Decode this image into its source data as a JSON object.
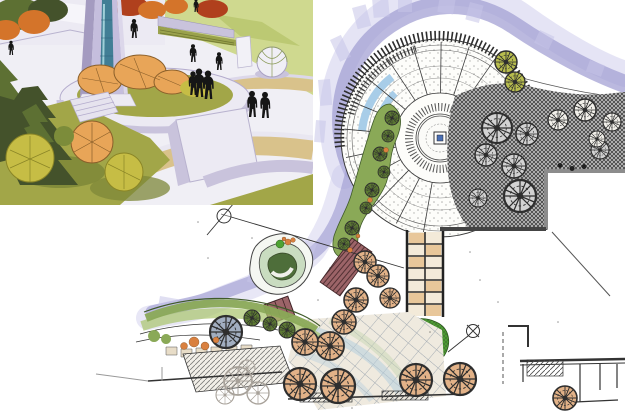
{
  "colors": {
    "paper": "#ffffff",
    "plazaLight": "#f0eff5",
    "bgGreen": "#cfd98f",
    "bgGreenDark": "#bcc973",
    "grassMid": "#a2a648",
    "grassLight": "#b7bb60",
    "grassShadow": "#7e8738",
    "wallLight": "#eceaf3",
    "wallMid": "#c9c3dc",
    "wallDark": "#a79fc2",
    "paveTan": "#d9c28b",
    "monumentBody": "#c5bedd",
    "monumentDark": "#a49bc0",
    "monumentEdge": "#dcd7ea",
    "glassTeal": "#417e95",
    "glassShine": "#9fd0d8",
    "shrubOrange": "#e8a558",
    "shrubOutline": "#8a5f2a",
    "shrubYellow": "#c6bd45",
    "shrubYellowLine": "#8a8526",
    "coniferDark": "#44522b",
    "coniferMid": "#5d7033",
    "autumnOrange": "#d4742a",
    "autumnRed": "#b0401d",
    "figure": "#161616",
    "ink": "#2e2e2e",
    "washMid": "#a19ed3",
    "washLight": "#c6c4e8",
    "rillBlue": "#a8cde8",
    "bandGreen": "#8aa957",
    "bandGreenLight": "#a9c46c",
    "bandEdge": "#3f5a2a",
    "hedgeGreen": "#4ea332",
    "maroon": "#9c6468",
    "maroonDark": "#3f2326",
    "paleTan": "#f3ead9",
    "tanCell": "#e8c79a",
    "stoneCell": "#e8ddc8",
    "tintBlue": "#b5cedd",
    "tintGreen": "#c8d6b4",
    "buildingGray": "#8c8c8c",
    "pencil": "#a8a29a",
    "rockOrange": "#d9803f",
    "centerBlue": "#4a6fb5",
    "islandGreen": "#4e6e3a",
    "islandGreenLight": "#c9dcc0",
    "massBase": "#c6c6c6"
  },
  "perspective": {
    "figures": [
      [
        134,
        38,
        0.8
      ],
      [
        193,
        62,
        0.75
      ],
      [
        219,
        70,
        0.75
      ],
      [
        193,
        95,
        1.0
      ],
      [
        199,
        97,
        1.2
      ],
      [
        208,
        99,
        1.2
      ],
      [
        252,
        117,
        1.1
      ],
      [
        265,
        118,
        1.1
      ],
      [
        196,
        12,
        0.55
      ],
      [
        11,
        55,
        0.6
      ]
    ]
  },
  "plan": {
    "plaza": {
      "cx": 440,
      "cy": 138,
      "spoke_r1": 45,
      "spoke_r2": 96,
      "spoke_a1": 100,
      "spoke_a2": 356,
      "spoke_n": 16
    },
    "treeColors": {
      "tan": "#e2b288",
      "mass": "#d2d2d2",
      "ink": "#f2f0ea",
      "olive": "#b8bd4e",
      "band": "#5d7a33",
      "bluegray": "#a2aec0",
      "pencil": "#ffffff"
    },
    "trees": [
      {
        "kind": "mass",
        "x": 497,
        "y": 128,
        "r": 15
      },
      {
        "kind": "mass",
        "x": 527,
        "y": 134,
        "r": 11
      },
      {
        "kind": "mass",
        "x": 486,
        "y": 155,
        "r": 11
      },
      {
        "kind": "mass",
        "x": 514,
        "y": 166,
        "r": 12
      },
      {
        "kind": "mass",
        "x": 520,
        "y": 196,
        "r": 16
      },
      {
        "kind": "mass",
        "x": 478,
        "y": 198,
        "r": 9
      },
      {
        "kind": "mass",
        "x": 600,
        "y": 150,
        "r": 9
      },
      {
        "kind": "ink",
        "x": 558,
        "y": 120,
        "r": 10
      },
      {
        "kind": "ink",
        "x": 585,
        "y": 110,
        "r": 11
      },
      {
        "kind": "ink",
        "x": 612,
        "y": 122,
        "r": 9
      },
      {
        "kind": "ink",
        "x": 597,
        "y": 139,
        "r": 8
      },
      {
        "kind": "olive",
        "x": 506,
        "y": 62,
        "r": 11
      },
      {
        "kind": "olive",
        "x": 515,
        "y": 82,
        "r": 10
      },
      {
        "kind": "band",
        "x": 392,
        "y": 118,
        "r": 7
      },
      {
        "kind": "band",
        "x": 388,
        "y": 136,
        "r": 6
      },
      {
        "kind": "band",
        "x": 380,
        "y": 154,
        "r": 7
      },
      {
        "kind": "band",
        "x": 384,
        "y": 172,
        "r": 6
      },
      {
        "kind": "band",
        "x": 372,
        "y": 190,
        "r": 7
      },
      {
        "kind": "band",
        "x": 366,
        "y": 208,
        "r": 6
      },
      {
        "kind": "band",
        "x": 352,
        "y": 228,
        "r": 7
      },
      {
        "kind": "band",
        "x": 344,
        "y": 244,
        "r": 6
      },
      {
        "kind": "band",
        "x": 252,
        "y": 318,
        "r": 8
      },
      {
        "kind": "band",
        "x": 270,
        "y": 324,
        "r": 7
      },
      {
        "kind": "band",
        "x": 287,
        "y": 330,
        "r": 8
      },
      {
        "kind": "bluegray",
        "x": 226,
        "y": 332,
        "r": 16
      },
      {
        "kind": "tan",
        "x": 365,
        "y": 262,
        "r": 11
      },
      {
        "kind": "tan",
        "x": 378,
        "y": 276,
        "r": 11
      },
      {
        "kind": "tan",
        "x": 356,
        "y": 300,
        "r": 12
      },
      {
        "kind": "tan",
        "x": 344,
        "y": 322,
        "r": 12
      },
      {
        "kind": "tan",
        "x": 390,
        "y": 298,
        "r": 10
      },
      {
        "kind": "tan",
        "x": 330,
        "y": 346,
        "r": 14
      },
      {
        "kind": "tan",
        "x": 305,
        "y": 342,
        "r": 13
      },
      {
        "kind": "tan",
        "x": 300,
        "y": 384,
        "r": 16
      },
      {
        "kind": "tan",
        "x": 338,
        "y": 386,
        "r": 17
      },
      {
        "kind": "tan",
        "x": 416,
        "y": 380,
        "r": 16
      },
      {
        "kind": "tan",
        "x": 460,
        "y": 379,
        "r": 16
      },
      {
        "kind": "tan",
        "x": 565,
        "y": 398,
        "r": 12
      },
      {
        "kind": "pencil",
        "x": 238,
        "y": 381,
        "r": 14
      },
      {
        "kind": "pencil",
        "x": 258,
        "y": 393,
        "r": 11
      },
      {
        "kind": "pencil",
        "x": 247,
        "y": 368,
        "r": 8
      },
      {
        "kind": "pencil",
        "x": 225,
        "y": 395,
        "r": 9
      }
    ],
    "washDabs": [
      [
        352,
        8,
        14,
        22,
        -15
      ],
      [
        372,
        -2,
        16,
        20,
        -5
      ],
      [
        398,
        -6,
        14,
        18,
        0
      ],
      [
        330,
        40,
        12,
        24,
        -25
      ],
      [
        318,
        80,
        12,
        26,
        -5
      ],
      [
        316,
        120,
        10,
        22,
        5
      ],
      [
        440,
        -4,
        16,
        16,
        10
      ],
      [
        470,
        2,
        14,
        18,
        15
      ],
      [
        540,
        30,
        16,
        14,
        25
      ],
      [
        590,
        60,
        16,
        12,
        20
      ],
      [
        300,
        238,
        18,
        12,
        20
      ],
      [
        250,
        270,
        16,
        12,
        15
      ],
      [
        160,
        296,
        18,
        10,
        10
      ]
    ],
    "accents": [
      [
        386,
        150,
        2.5
      ],
      [
        370,
        200,
        2.5
      ],
      [
        350,
        250,
        2.5
      ],
      [
        358,
        236,
        2
      ],
      [
        288,
        242,
        3
      ],
      [
        293,
        240,
        2.3
      ],
      [
        284,
        239,
        2
      ],
      [
        194,
        342,
        5
      ],
      [
        205,
        346,
        4
      ],
      [
        184,
        346,
        3.5
      ],
      [
        216,
        340,
        3
      ]
    ],
    "specks": [
      [
        330,
        268
      ],
      [
        318,
        300
      ],
      [
        252,
        238
      ],
      [
        208,
        258
      ],
      [
        470,
        252
      ],
      [
        498,
        302
      ],
      [
        352,
        408
      ],
      [
        558,
        322
      ],
      [
        198,
        222
      ],
      [
        302,
        198
      ],
      [
        430,
        332
      ],
      [
        480,
        280
      ]
    ]
  }
}
